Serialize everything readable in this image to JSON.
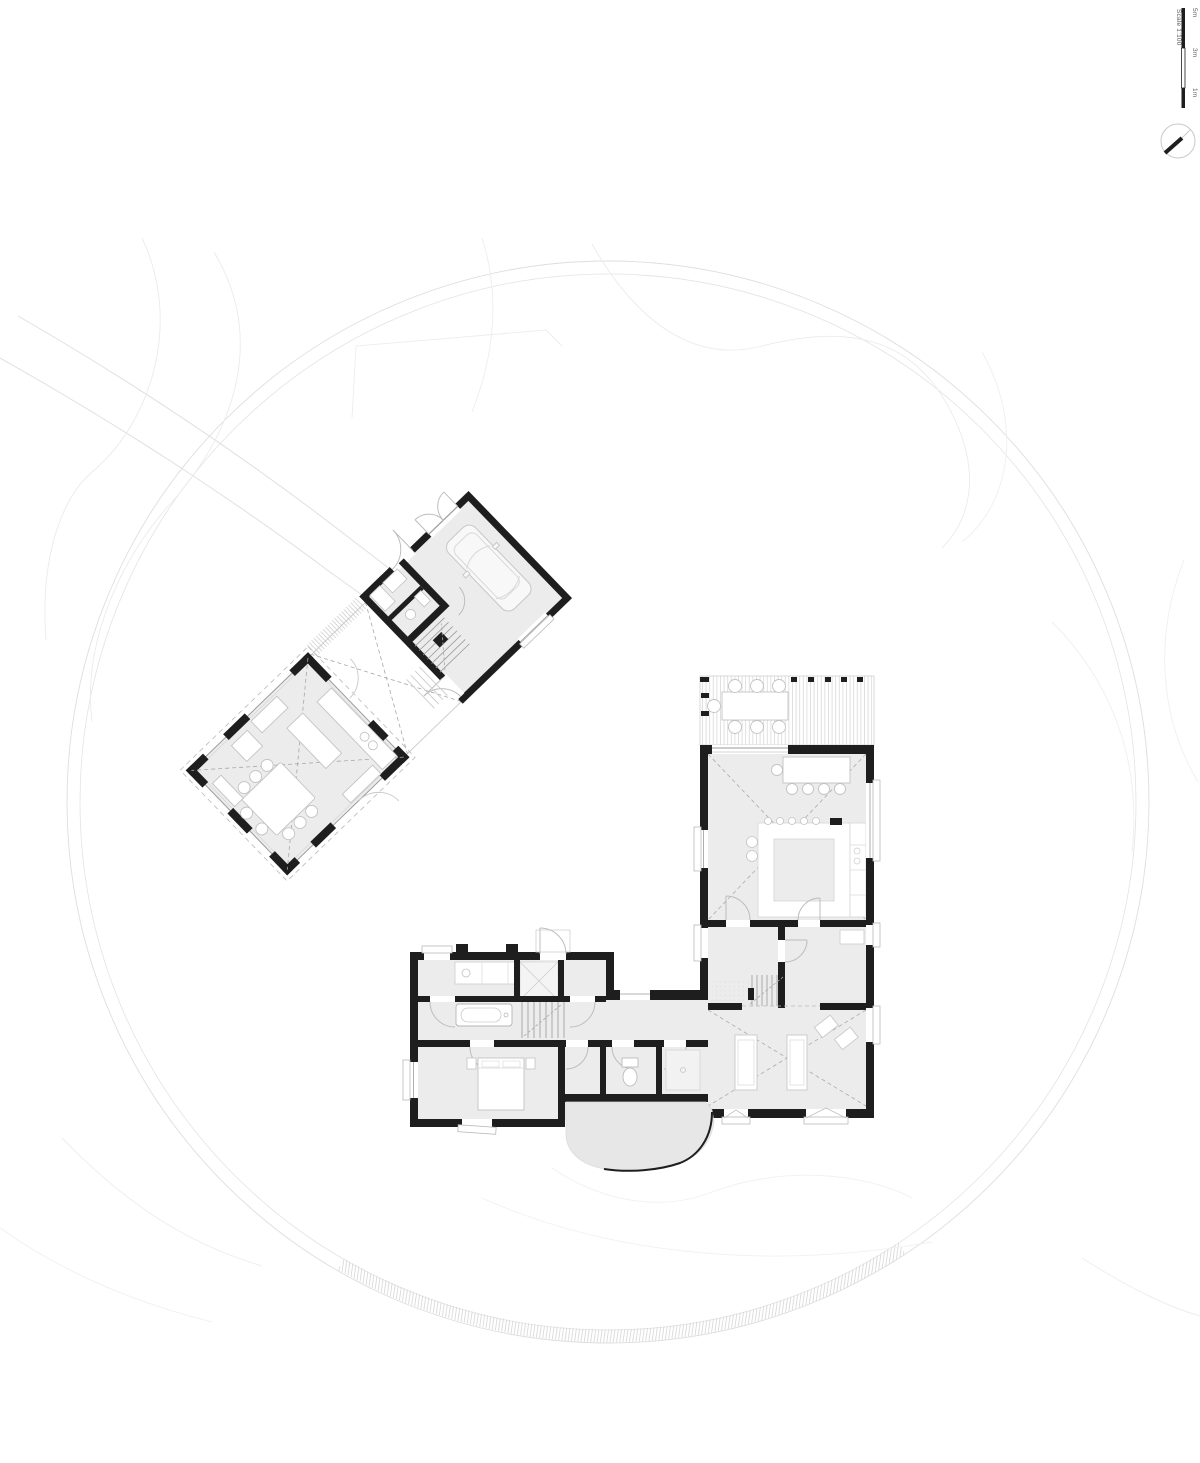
{
  "sheet": {
    "type": "architectural site / floor plan drawing",
    "paper_color": "#ffffff"
  },
  "scale_bar": {
    "label": "Scale 1:100",
    "ticks": [
      "5m",
      "3m",
      "1m"
    ]
  },
  "north_arrow": {
    "icon": "north-arrow-icon"
  },
  "colors": {
    "wall": "#1e1e1e",
    "floor": "#ececec",
    "terrace": "#e7e7e7",
    "contour": "#e4e4e4",
    "furniture_stroke": "#c3c3c3",
    "roof_dash": "#a8a8a8",
    "deck_board": "#d9d9d9"
  }
}
